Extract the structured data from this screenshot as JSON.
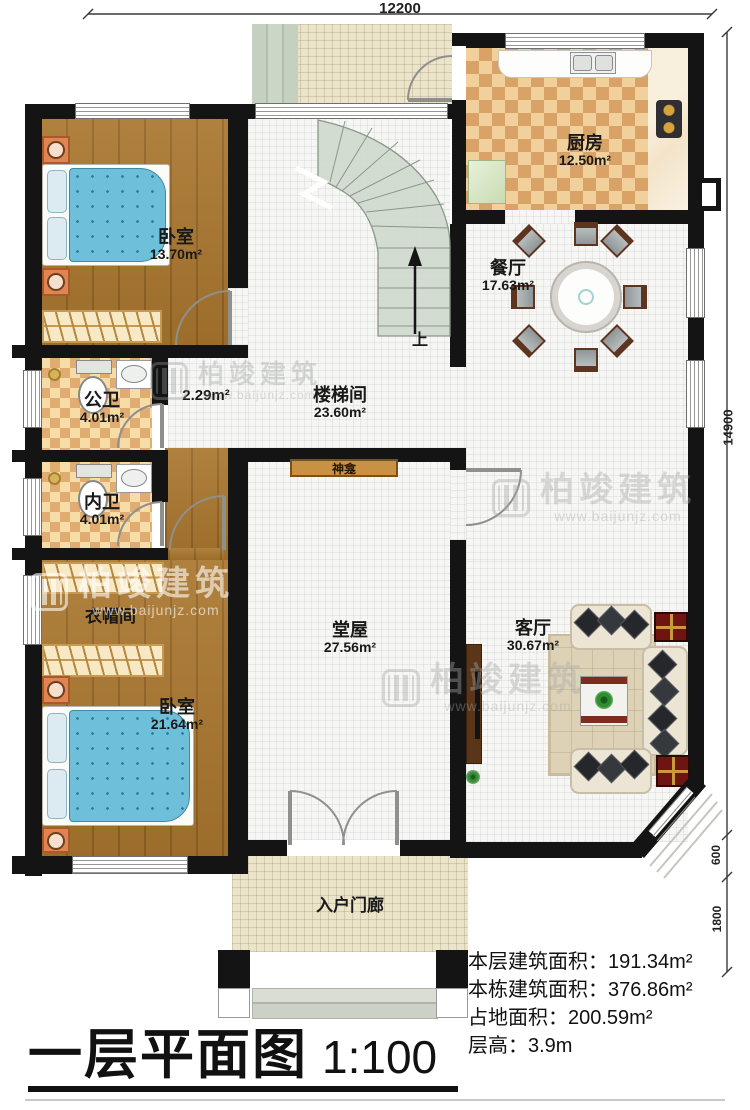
{
  "title": {
    "text": "一层平面图",
    "scale": "1:100"
  },
  "dimensions": {
    "top": "12200",
    "right": "14900",
    "right_small_1": "600",
    "right_small_2": "1800"
  },
  "stats": [
    {
      "label": "本层建筑面积：",
      "value": "191.34m²"
    },
    {
      "label": "本栋建筑面积：",
      "value": "376.86m²"
    },
    {
      "label": "占地面积：",
      "value": "200.59m²"
    },
    {
      "label": "层高：",
      "value": "3.9m"
    }
  ],
  "rooms": {
    "bedroom_top": {
      "name": "卧室",
      "area": "13.70m²"
    },
    "kitchen": {
      "name": "厨房",
      "area": "12.50m²"
    },
    "dining": {
      "name": "餐厅",
      "area": "17.63m²"
    },
    "stair_hall": {
      "name": "楼梯间",
      "area": "23.60m²"
    },
    "hallway": {
      "area": "2.29m²"
    },
    "public_bath": {
      "name": "公卫",
      "area": "4.01m²"
    },
    "private_bath": {
      "name": "内卫",
      "area": "4.01m²"
    },
    "cloakroom": {
      "name": "衣帽间"
    },
    "bedroom_bottom": {
      "name": "卧室",
      "area": "21.64m²"
    },
    "main_hall": {
      "name": "堂屋",
      "area": "27.56m²"
    },
    "shrine": {
      "name": "神龛"
    },
    "living": {
      "name": "客厅",
      "area": "30.67m²"
    },
    "porch": {
      "name": "入户门廊"
    }
  },
  "stairs": {
    "direction_label": "上"
  },
  "watermark": {
    "brand": "柏竣建筑",
    "url": "www.baijunjz.com"
  }
}
